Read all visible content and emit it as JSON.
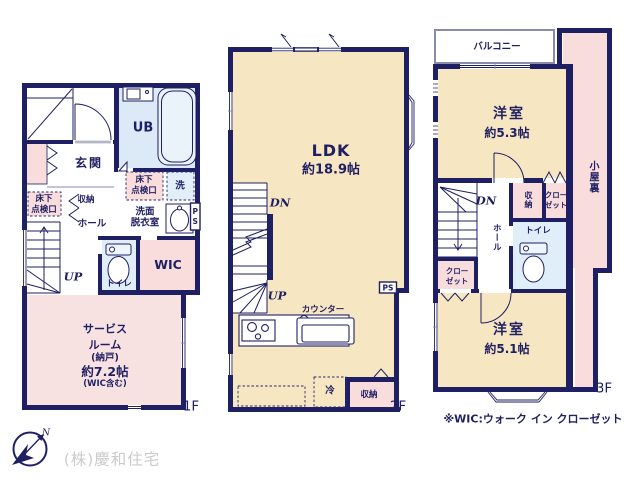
{
  "colors": {
    "wall": "#1f1f63",
    "room_cream": "#f7e6c2",
    "room_pink": "#f8dddc",
    "room_blue": "#dbeaf6",
    "window_gray": "#8a8aac",
    "company_gray": "#cbcbcb"
  },
  "floors": {
    "f1": {
      "floor_label": "1F",
      "ub": "UB",
      "inspection_right_l1": "床下",
      "inspection_right_l2": "点検口",
      "laundry": "洗",
      "washroom_l1": "洗面",
      "washroom_l2": "脱衣室",
      "ps": "PS",
      "entrance": "玄関",
      "inspection_left_l1": "床下",
      "inspection_left_l2": "点検口",
      "storage": "収納",
      "hall": "ホール",
      "wic": "WIC",
      "toilet": "トイレ",
      "up": "UP",
      "service_l1": "サービス",
      "service_l2": "ルーム",
      "service_l3": "(納戸)",
      "service_size": "約7.2帖",
      "service_note": "(WIC含む)"
    },
    "f2": {
      "floor_label": "2F",
      "ldk": "LDK",
      "ldk_size": "約18.9帖",
      "dn": "DN",
      "up": "UP",
      "counter": "カウンター",
      "fridge": "冷",
      "storage": "収納",
      "ps": "PS"
    },
    "f3": {
      "floor_label": "3F",
      "balcony": "バルコニー",
      "bedroom1": "洋室",
      "bedroom1_size": "約5.3帖",
      "attic": "小屋裏",
      "dn": "DN",
      "storage": "収納",
      "closet1_l1": "クロー",
      "closet1_l2": "ゼット",
      "hall": "ホール",
      "toilet": "トイレ",
      "closet2_l1": "クロー",
      "closet2_l2": "ゼット",
      "bedroom2": "洋室",
      "bedroom2_size": "約5.1帖"
    }
  },
  "footer": {
    "wic_note": "※WIC:ウォーク イン クローゼット",
    "company": "(株)慶和住宅",
    "compass_north": "N"
  }
}
